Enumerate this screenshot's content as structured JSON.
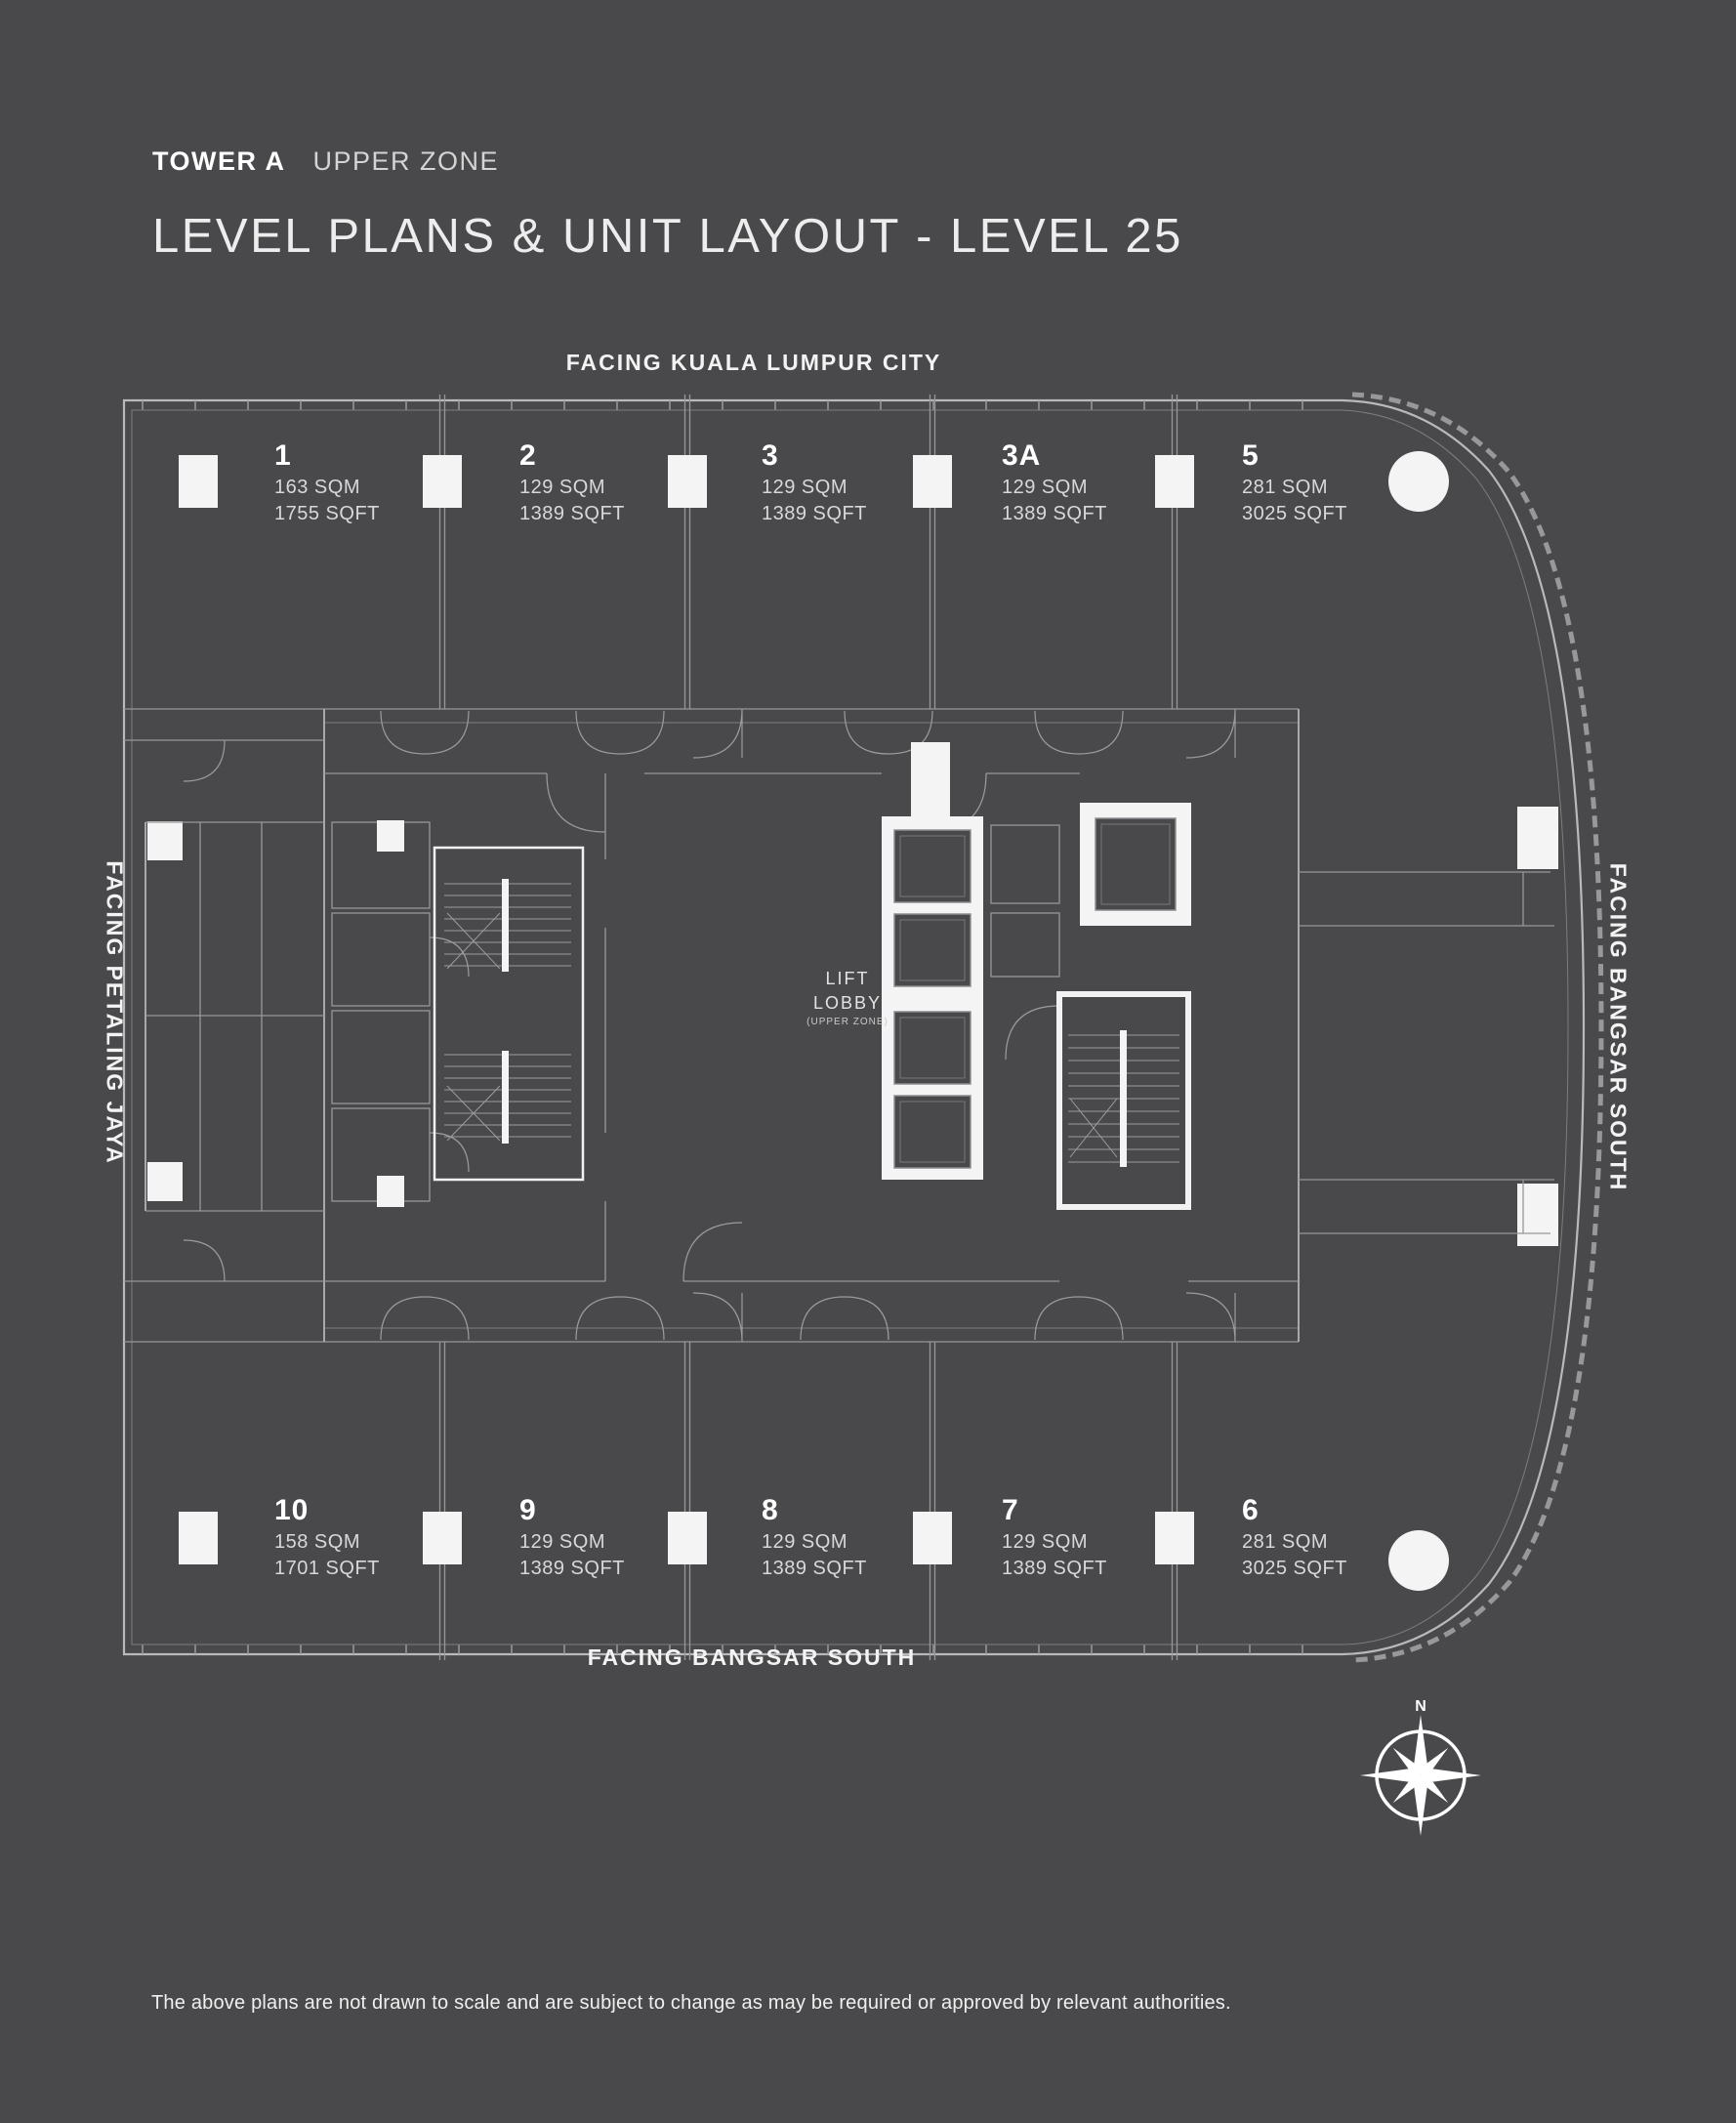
{
  "colors": {
    "background": "#49494b",
    "plan_line": "#9a9a9c",
    "wall_white": "#f2f2f2",
    "text_primary": "#ffffff",
    "text_secondary": "#d8d8d8"
  },
  "header": {
    "tower": "TOWER A",
    "zone": "UPPER ZONE",
    "title": "LEVEL PLANS & UNIT LAYOUT - LEVEL 25"
  },
  "orientation": {
    "top": "FACING KUALA LUMPUR CITY",
    "bottom": "FACING BANGSAR SOUTH",
    "left": "FACING PETALING JAYA",
    "right": "FACING BANGSAR SOUTH"
  },
  "floor_plan": {
    "lift_lobby": {
      "line1": "LIFT",
      "line2": "LOBBY",
      "line3": "(UPPER ZONE)"
    },
    "units_top": [
      {
        "id": "1",
        "sqm": "163 SQM",
        "sqft": "1755 SQFT"
      },
      {
        "id": "2",
        "sqm": "129 SQM",
        "sqft": "1389 SQFT"
      },
      {
        "id": "3",
        "sqm": "129 SQM",
        "sqft": "1389 SQFT"
      },
      {
        "id": "3A",
        "sqm": "129 SQM",
        "sqft": "1389 SQFT"
      },
      {
        "id": "5",
        "sqm": "281 SQM",
        "sqft": "3025 SQFT"
      }
    ],
    "units_bottom": [
      {
        "id": "10",
        "sqm": "158 SQM",
        "sqft": "1701 SQFT"
      },
      {
        "id": "9",
        "sqm": "129 SQM",
        "sqft": "1389 SQFT"
      },
      {
        "id": "8",
        "sqm": "129 SQM",
        "sqft": "1389 SQFT"
      },
      {
        "id": "7",
        "sqm": "129 SQM",
        "sqft": "1389 SQFT"
      },
      {
        "id": "6",
        "sqm": "281 SQM",
        "sqft": "3025 SQFT"
      }
    ]
  },
  "compass": {
    "north_label": "N"
  },
  "footer": {
    "disclaimer": "The above plans are not drawn to scale and are subject to change as may be required or approved by relevant authorities."
  }
}
